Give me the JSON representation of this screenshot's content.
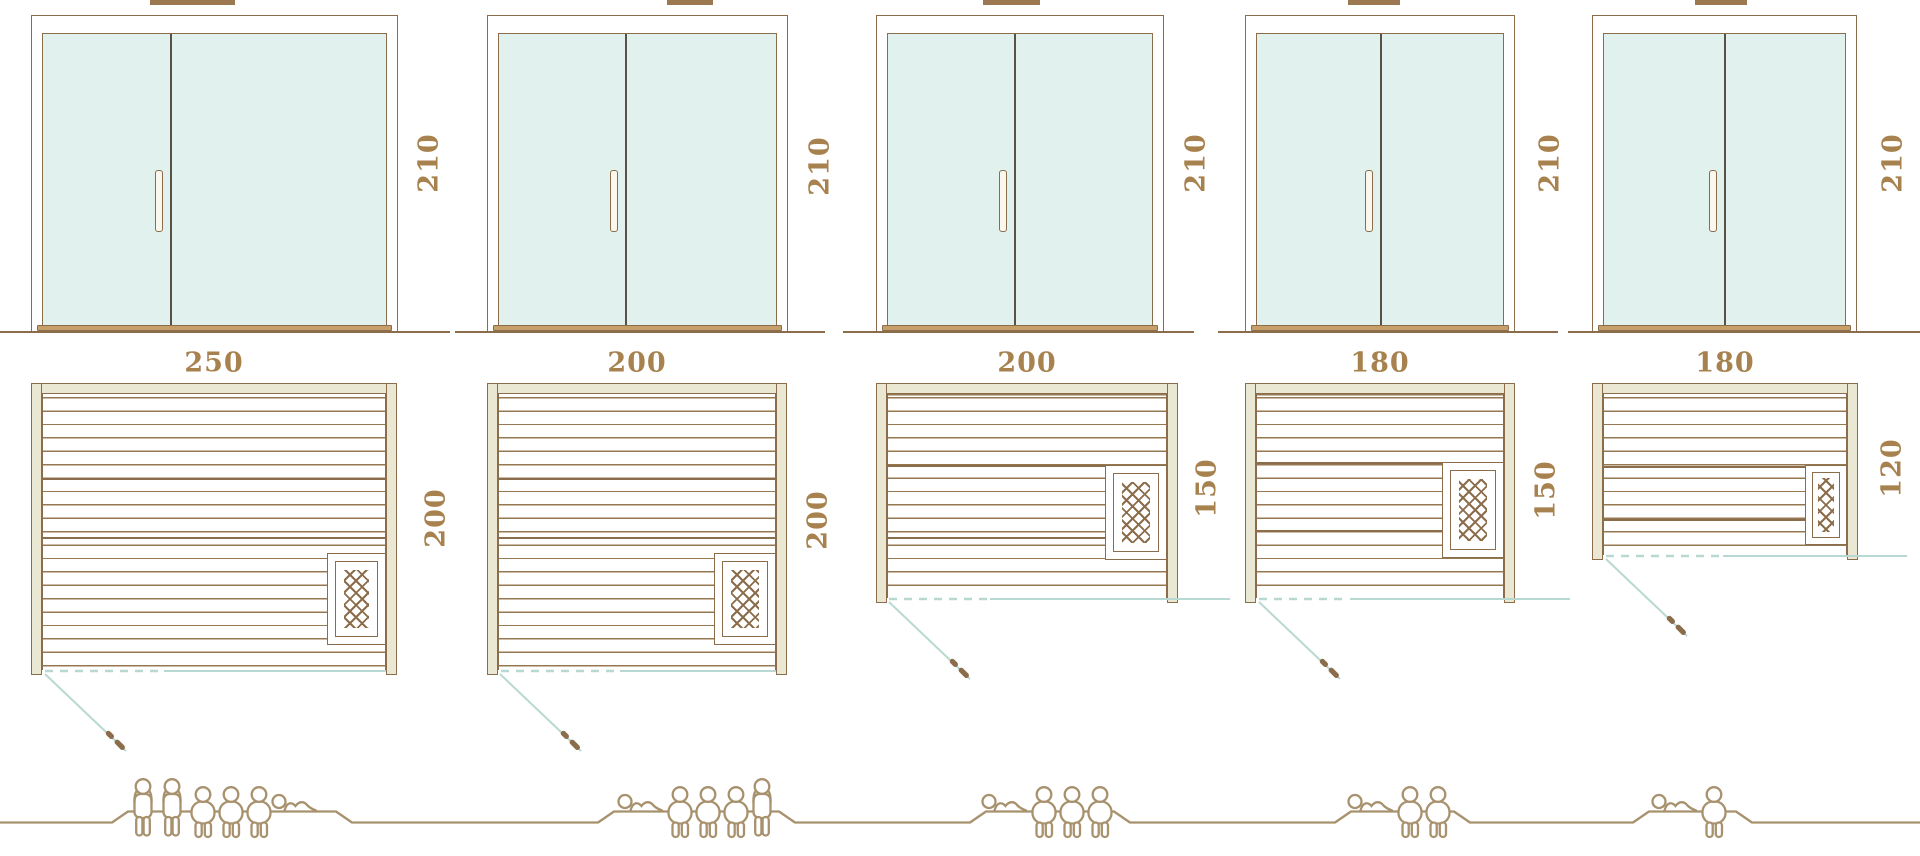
{
  "diagram": {
    "type": "sauna-size-comparison",
    "colors": {
      "line_brown": "#8c6d4b",
      "glass_mint": "#e1f1ed",
      "wall_beige": "#eae7d2",
      "teal_line": "#b7d9d1",
      "dimension_text": "#a7824f",
      "figure_outline": "#a8926e",
      "plank_line": "#967850",
      "sill_tan": "#c69f6b"
    },
    "units": [
      {
        "name": "sauna-250x200",
        "door_height_cm": "210",
        "width_cm": "250",
        "depth_cm": "200",
        "capacity_total": 6,
        "capacity_figures": [
          "standing",
          "standing",
          "seated",
          "seated",
          "seated",
          "reclining"
        ]
      },
      {
        "name": "sauna-200x200",
        "door_height_cm": "210",
        "width_cm": "200",
        "depth_cm": "200",
        "capacity_total": 5,
        "capacity_figures": [
          "reclining",
          "seated",
          "seated",
          "seated",
          "standing"
        ]
      },
      {
        "name": "sauna-200x150",
        "door_height_cm": "210",
        "width_cm": "200",
        "depth_cm": "150",
        "capacity_total": 4,
        "capacity_figures": [
          "reclining",
          "seated",
          "seated",
          "seated"
        ]
      },
      {
        "name": "sauna-180x150",
        "door_height_cm": "210",
        "width_cm": "180",
        "depth_cm": "150",
        "capacity_total": 3,
        "capacity_figures": [
          "reclining",
          "seated",
          "seated"
        ]
      },
      {
        "name": "sauna-180x120",
        "door_height_cm": "210",
        "width_cm": "180",
        "depth_cm": "120",
        "capacity_total": 2,
        "capacity_figures": [
          "reclining",
          "seated"
        ]
      }
    ]
  }
}
